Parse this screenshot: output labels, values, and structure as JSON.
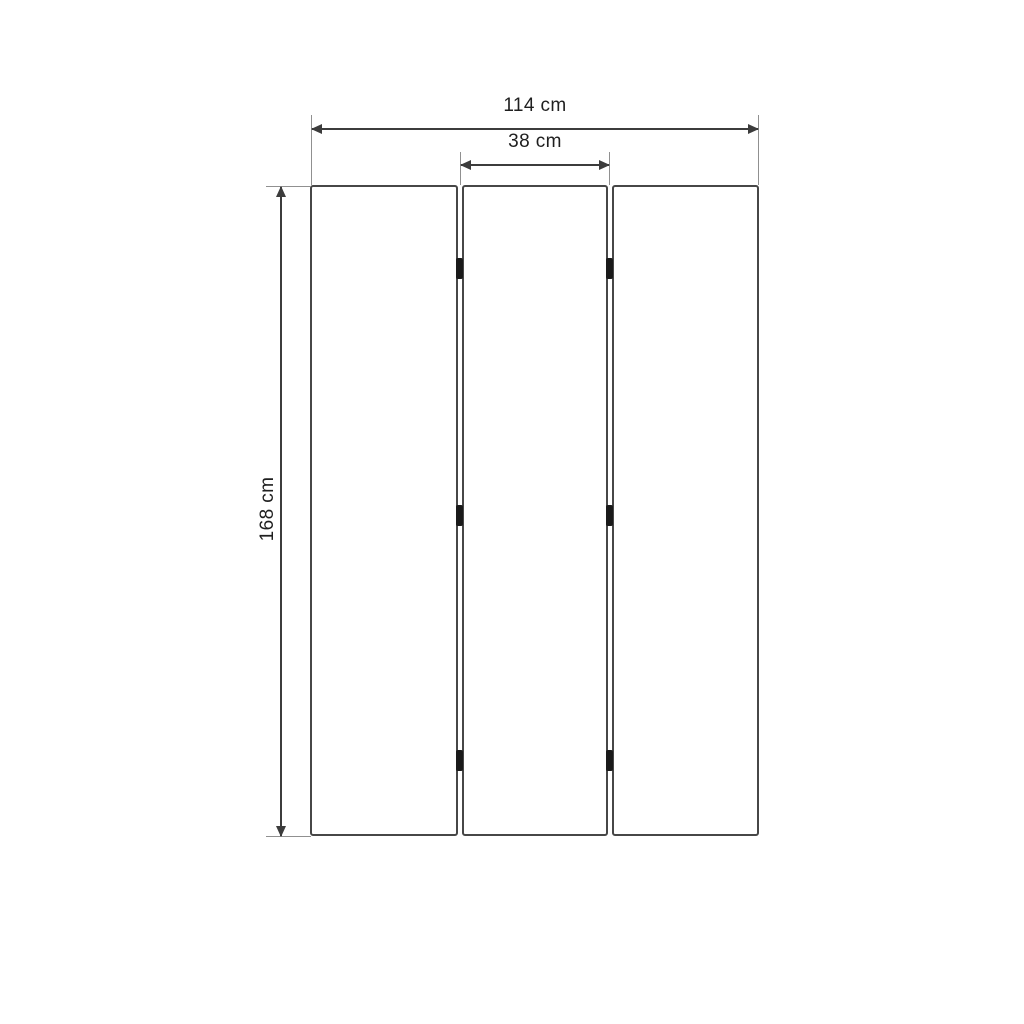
{
  "diagram": {
    "type": "technical-dimension-drawing",
    "subject": "three-panel folding screen, front view",
    "panels": {
      "count": 3
    },
    "hinges": {
      "count": 6,
      "rows": 3,
      "columns": 2
    },
    "dimensions": {
      "total_width": {
        "label": "114 cm",
        "value": 114,
        "unit": "cm"
      },
      "panel_width": {
        "label": "38 cm",
        "value": 38,
        "unit": "cm"
      },
      "height": {
        "label": "168 cm",
        "value": 168,
        "unit": "cm"
      }
    },
    "colors": {
      "background": "#ffffff",
      "dimension_line": "#3c3c3c",
      "extension_line": "#909090",
      "panel_border": "#474747",
      "hinge": "#1a1a1a",
      "text": "#1f1f1f"
    }
  }
}
